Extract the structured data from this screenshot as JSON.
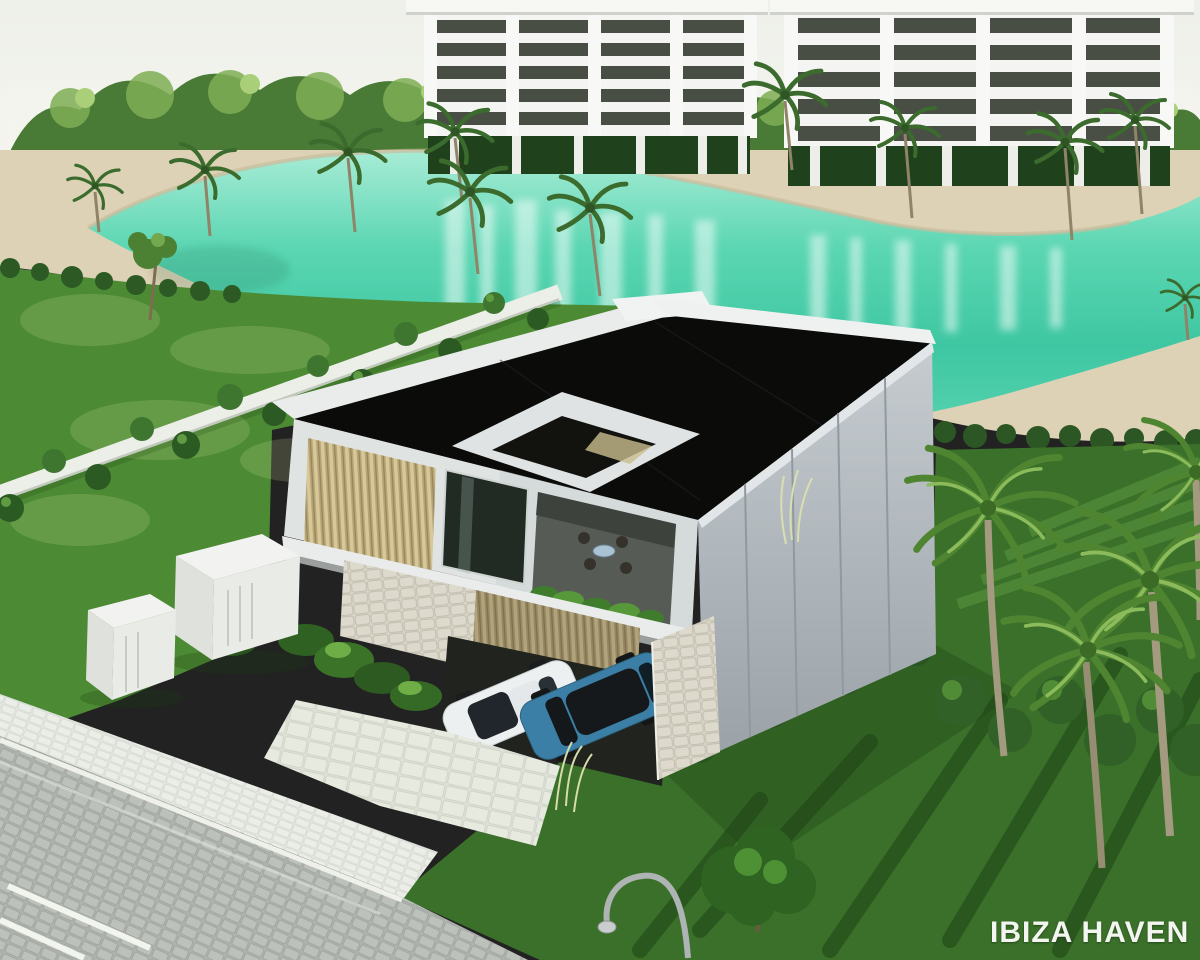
{
  "watermark": {
    "text": "IBIZA HAVEN",
    "color": "#f3f5f0"
  },
  "palette": {
    "sky": "#eef0ea",
    "tree_dark": "#3a6a2e",
    "tree_light": "#86b356",
    "building_white": "#f4f5f2",
    "window_dark": "#3b4037",
    "sand": "#ddd2b6",
    "water_turquoise": "#41c9a4",
    "water_light": "#a8ecd6",
    "grass": "#4c8a33",
    "grass_dark": "#3a7029",
    "roof": "#0b0b09",
    "villa_white": "#e7eae9",
    "villa_grey_wall": "#b3bac0",
    "slat_wood": "#c9b98a",
    "stone": "#d5d2c4",
    "car_white": "#edf0f1",
    "car_blue": "#3c7fa6",
    "road": "#b7bcb7",
    "lamp_grey": "#aeb3b4"
  }
}
